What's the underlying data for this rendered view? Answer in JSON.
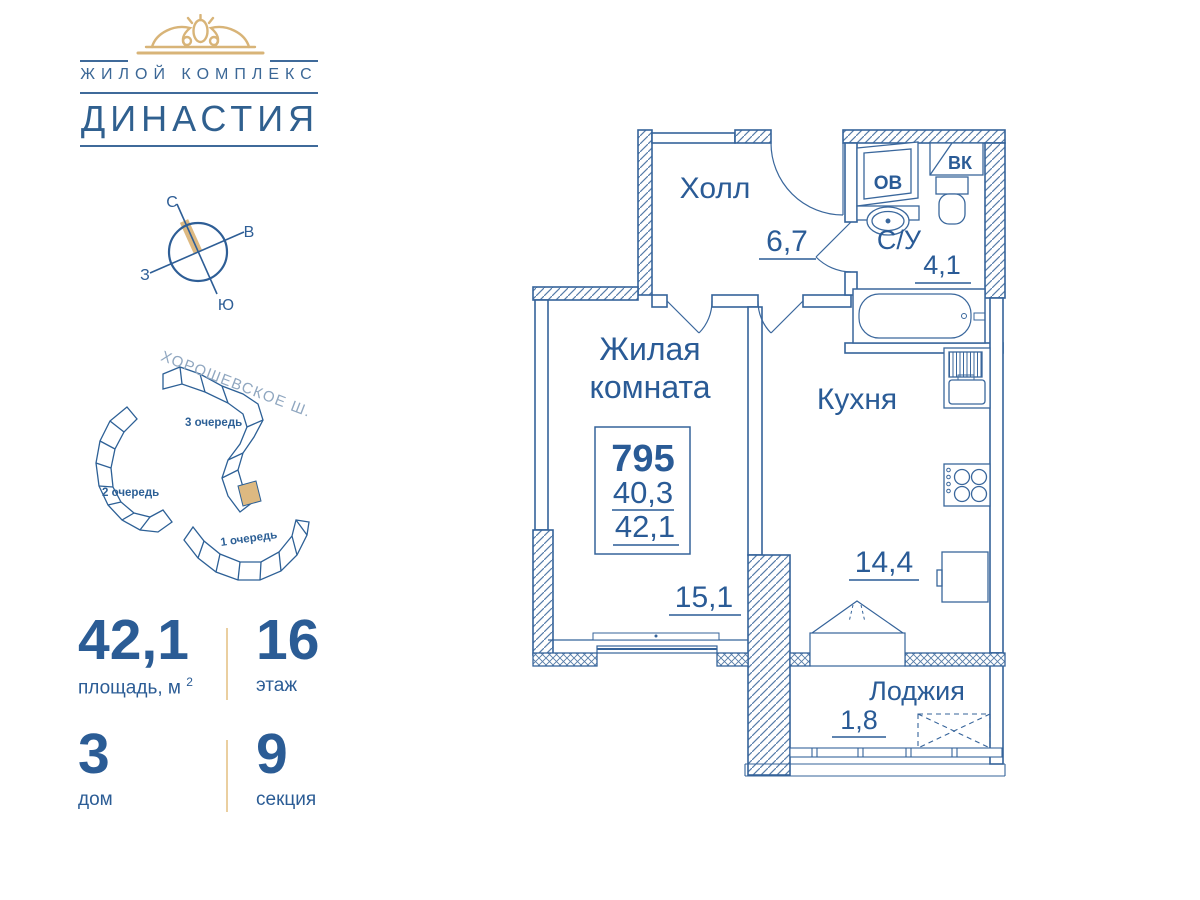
{
  "logo": {
    "complex": "ЖИЛОЙ КОМПЛЕКС",
    "name": "ДИНАСТИЯ"
  },
  "compass": {
    "north": "С",
    "east": "В",
    "west": "З",
    "south": "Ю"
  },
  "site": {
    "street": "ХОРОШЕВСКОЕ Ш.",
    "phase3": "3 очередь",
    "phase2": "2 очередь",
    "phase1": "1 очередь"
  },
  "stats": {
    "area": "42,1",
    "area_label": "площадь, м",
    "area_sup": "2",
    "floor": "16",
    "floor_label": "этаж",
    "house": "3",
    "house_label": "дом",
    "section": "9",
    "section_label": "секция"
  },
  "plan": {
    "hall": "Холл",
    "hall_area": "6,7",
    "wc": "С/У",
    "wc_area": "4,1",
    "living_line1": "Жилая",
    "living_line2": "комната",
    "living_area": "15,1",
    "kitchen": "Кухня",
    "kitchen_area": "14,4",
    "loggia": "Лоджия",
    "loggia_area": "1,8",
    "apt_number": "795",
    "apt_area_living": "40,3",
    "apt_area_total": "42,1",
    "shaft_ov": "ОВ",
    "shaft_vk": "ВК"
  },
  "colors": {
    "blue": "#2e5e96",
    "gold": "#ddb981"
  }
}
